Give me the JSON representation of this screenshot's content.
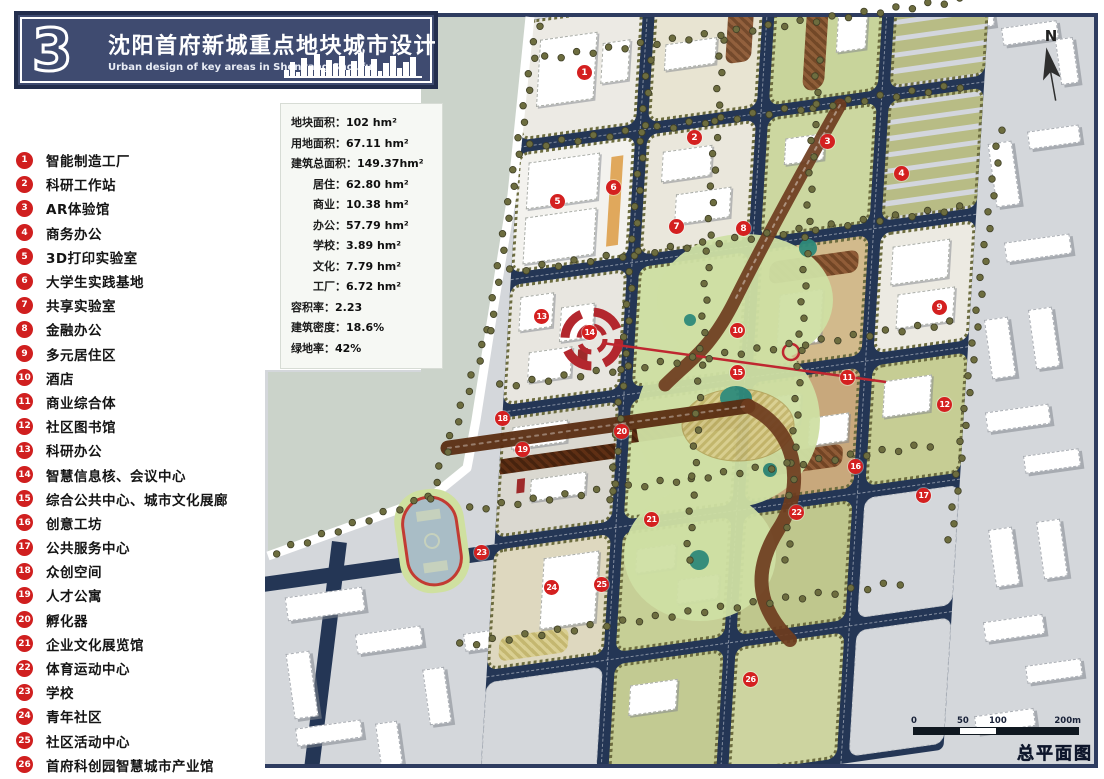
{
  "title_block": {
    "number": "3",
    "title_cn": "沈阳首府新城重点地块城市设计",
    "title_en": "Urban design of key areas in Shenyang Shoufu"
  },
  "legend": {
    "items": [
      {
        "num": "1",
        "label": "智能制造工厂"
      },
      {
        "num": "2",
        "label": "科研工作站"
      },
      {
        "num": "3",
        "label": "AR体验馆"
      },
      {
        "num": "4",
        "label": "商务办公"
      },
      {
        "num": "5",
        "label": "3D打印实验室"
      },
      {
        "num": "6",
        "label": "大学生实践基地"
      },
      {
        "num": "7",
        "label": "共享实验室"
      },
      {
        "num": "8",
        "label": "金融办公"
      },
      {
        "num": "9",
        "label": "多元居住区"
      },
      {
        "num": "10",
        "label": "酒店"
      },
      {
        "num": "11",
        "label": "商业综合体"
      },
      {
        "num": "12",
        "label": "社区图书馆"
      },
      {
        "num": "13",
        "label": "科研办公"
      },
      {
        "num": "14",
        "label": "智慧信息核、会议中心"
      },
      {
        "num": "15",
        "label": "综合公共中心、城市文化展廊"
      },
      {
        "num": "16",
        "label": "创意工坊"
      },
      {
        "num": "17",
        "label": "公共服务中心"
      },
      {
        "num": "18",
        "label": "众创空间"
      },
      {
        "num": "19",
        "label": "人才公寓"
      },
      {
        "num": "20",
        "label": "孵化器"
      },
      {
        "num": "21",
        "label": "企业文化展览馆"
      },
      {
        "num": "22",
        "label": "体育运动中心"
      },
      {
        "num": "23",
        "label": "学校"
      },
      {
        "num": "24",
        "label": "青年社区"
      },
      {
        "num": "25",
        "label": "社区活动中心"
      },
      {
        "num": "26",
        "label": "首府科创园智慧城市产业馆"
      }
    ]
  },
  "stats": {
    "sep": "：",
    "lines": [
      {
        "label": "地块面积",
        "value": "102 hm²",
        "indent": 0
      },
      {
        "label": "用地面积",
        "value": "67.11 hm²",
        "indent": 0
      },
      {
        "label": "建筑总面积",
        "value": "149.37hm²",
        "indent": 0
      },
      {
        "label": "居住",
        "value": "62.80 hm²",
        "indent": 1
      },
      {
        "label": "商业",
        "value": "10.38 hm²",
        "indent": 1
      },
      {
        "label": "办公",
        "value": "57.79 hm²",
        "indent": 1
      },
      {
        "label": "学校",
        "value": "3.89 hm²",
        "indent": 1
      },
      {
        "label": "文化",
        "value": "7.79 hm²",
        "indent": 1
      },
      {
        "label": "工厂",
        "value": "6.72 hm²",
        "indent": 1
      },
      {
        "label": "容积率",
        "value": "2.23",
        "indent": 0
      },
      {
        "label": "建筑密度",
        "value": "18.6%",
        "indent": 0
      },
      {
        "label": "绿地率",
        "value": "42%",
        "indent": 0
      }
    ]
  },
  "map": {
    "north_label": "N",
    "plan_label": "总平面图",
    "scale_labels": [
      "0",
      "50",
      "100",
      "200m"
    ],
    "markers": [
      {
        "num": "1",
        "x": 585,
        "y": 73
      },
      {
        "num": "2",
        "x": 695,
        "y": 138
      },
      {
        "num": "3",
        "x": 828,
        "y": 142
      },
      {
        "num": "4",
        "x": 902,
        "y": 174
      },
      {
        "num": "5",
        "x": 558,
        "y": 202
      },
      {
        "num": "6",
        "x": 614,
        "y": 188
      },
      {
        "num": "7",
        "x": 677,
        "y": 227
      },
      {
        "num": "8",
        "x": 744,
        "y": 229
      },
      {
        "num": "9",
        "x": 940,
        "y": 308
      },
      {
        "num": "10",
        "x": 738,
        "y": 331
      },
      {
        "num": "11",
        "x": 848,
        "y": 378
      },
      {
        "num": "12",
        "x": 945,
        "y": 405
      },
      {
        "num": "13",
        "x": 542,
        "y": 317
      },
      {
        "num": "14",
        "x": 590,
        "y": 333
      },
      {
        "num": "15",
        "x": 738,
        "y": 373
      },
      {
        "num": "16",
        "x": 856,
        "y": 467
      },
      {
        "num": "17",
        "x": 924,
        "y": 496
      },
      {
        "num": "18",
        "x": 503,
        "y": 419
      },
      {
        "num": "19",
        "x": 523,
        "y": 450
      },
      {
        "num": "20",
        "x": 622,
        "y": 432
      },
      {
        "num": "21",
        "x": 652,
        "y": 520
      },
      {
        "num": "22",
        "x": 797,
        "y": 513
      },
      {
        "num": "23",
        "x": 482,
        "y": 553
      },
      {
        "num": "24",
        "x": 552,
        "y": 588
      },
      {
        "num": "25",
        "x": 602,
        "y": 585
      },
      {
        "num": "26",
        "x": 751,
        "y": 680
      }
    ],
    "colors": {
      "road_navy": "#243655",
      "marker_red": "#d42020",
      "water": "#cbd3ca",
      "park_green": "#cfe0a4",
      "context_gray": "#d4d7db",
      "axis_red": "#bf2730",
      "title_navy": "#3f4b70"
    }
  }
}
